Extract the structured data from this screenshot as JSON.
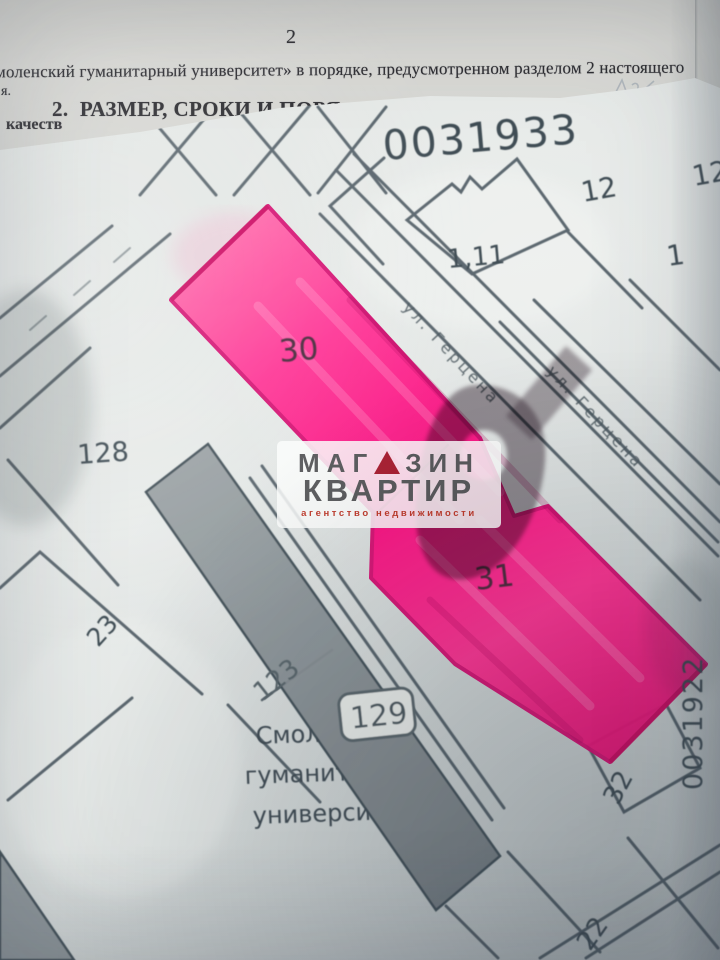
{
  "document": {
    "page_number": "2",
    "body_line": "моленский гуманитарный университет» в порядке, предусмотренном разделом 2 настоящего",
    "margin_mark": "я.",
    "heading": "2.  РАЗМЕР, СРОКИ И ПОРЯ",
    "left_fragment": "качеств"
  },
  "map": {
    "quarter_number_top": "0031933",
    "quarter_number_right": "0031922",
    "street_label_1": "ул. Герцена",
    "street_label_2": "ул. Герцена",
    "labels": {
      "p12a": "12",
      "p12b": "12",
      "p1": "1",
      "p111": "1,11",
      "p128": "128",
      "p23": "23",
      "p30": "30",
      "p31": "31",
      "p123": "123",
      "p129": "129",
      "p32": "32",
      "p22": "22"
    },
    "university_text": [
      "Смоленский",
      "гуманитарный",
      "университет"
    ]
  },
  "watermark": {
    "word1_left": "МАГ",
    "word1_right": "ЗИН",
    "word2": "КВАРТИР",
    "tagline": "агентство недвижимости"
  },
  "colors": {
    "highlight_pink": "#fa0e81",
    "map_line": "#3e4b54",
    "paper": "#e4e8e6",
    "building_fill": "#8d9599",
    "logo_text": "#58595b",
    "logo_accent": "#a81e31",
    "tagline": "#bf3a2b"
  }
}
